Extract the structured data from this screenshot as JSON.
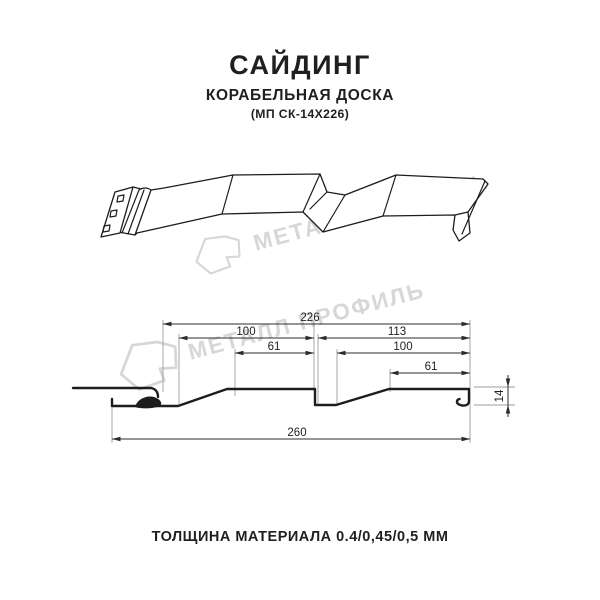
{
  "header": {
    "title": "САЙДИНГ",
    "subtitle": "КОРАБЕЛЬНАЯ ДОСКА",
    "model": "(МП СК-14Х226)"
  },
  "watermark": {
    "text": "МЕТАЛЛ ПРОФИЛЬ"
  },
  "diagram": {
    "type": "technical-profile-drawing",
    "views": [
      "3d-perspective-panel",
      "dimensioned-cross-section"
    ],
    "units": "ММ",
    "dimensions": {
      "total_width": 260,
      "useful_width": 226,
      "board1_width": 100,
      "board2_width": 113,
      "board1_flat": 61,
      "board2_flat": 100,
      "board2_inner_flat": 61,
      "profile_height": 14
    },
    "labels": {
      "d226": "226",
      "d100a": "100",
      "d113": "113",
      "d61a": "61",
      "d100b": "100",
      "d61b": "61",
      "d260": "260",
      "d14": "14"
    }
  },
  "footer": {
    "thickness": "ТОЛЩИНА МАТЕРИАЛА 0.4/0,45/0,5 ММ"
  },
  "colors": {
    "line": "#1d1d1d",
    "dimension": "#2c2c2c",
    "extension": "#9e9e9e",
    "watermark": "#d7d7d7",
    "text": "#1f1f1f",
    "background": "#ffffff"
  }
}
